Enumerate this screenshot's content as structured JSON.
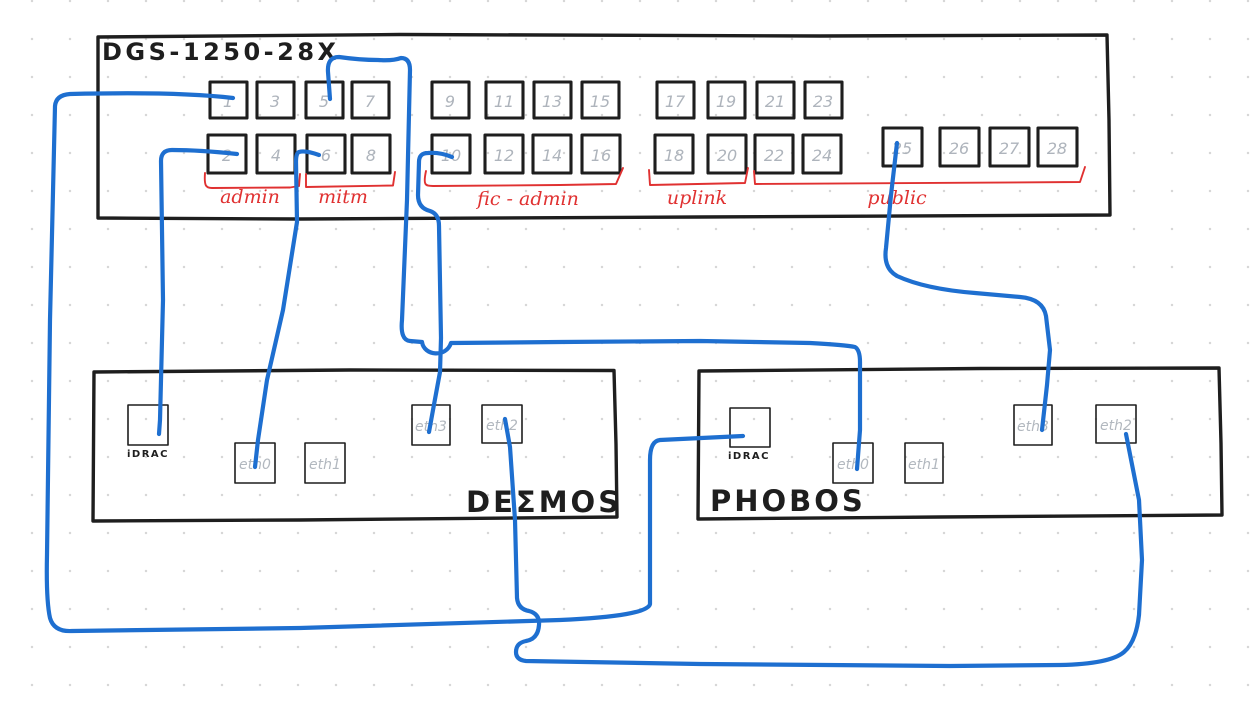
{
  "palette": {
    "background": "#ffffff",
    "ink": "#1e1e1e",
    "cable_blue": "#1e6fd0",
    "group_red": "#e03131",
    "muted_gray": "#aeb4bc"
  },
  "switch": {
    "title": "DGS-1250-28X",
    "ports": [
      "1",
      "2",
      "3",
      "4",
      "5",
      "6",
      "7",
      "8",
      "9",
      "10",
      "11",
      "12",
      "13",
      "14",
      "15",
      "16",
      "17",
      "18",
      "19",
      "20",
      "21",
      "22",
      "23",
      "24",
      "25",
      "26",
      "27",
      "28"
    ],
    "groups": [
      {
        "label": "admin",
        "ports": [
          1,
          2,
          3,
          4
        ]
      },
      {
        "label": "mitm",
        "ports": [
          5,
          6,
          7,
          8
        ]
      },
      {
        "label": "fic - admin",
        "ports": [
          9,
          10,
          11,
          12,
          13,
          14,
          15,
          16
        ]
      },
      {
        "label": "uplink",
        "ports": [
          17,
          18,
          19,
          20
        ]
      },
      {
        "label": "public",
        "ports": [
          21,
          22,
          23,
          24,
          25,
          26,
          27,
          28
        ]
      }
    ]
  },
  "servers": [
    {
      "name": "DEΣMOS",
      "ports": [
        "iDRAC",
        "eth0",
        "eth1",
        "eth3",
        "eth2"
      ]
    },
    {
      "name": "PHOBOS",
      "ports": [
        "iDRAC",
        "eth0",
        "eth1",
        "eth3",
        "eth2"
      ]
    }
  ],
  "connections": [
    {
      "from": "switch port 1 (admin)",
      "to": "PHOBOS iDRAC"
    },
    {
      "from": "switch port 2 (admin)",
      "to": "DEΣMOS iDRAC"
    },
    {
      "from": "switch port 5 (mitm)",
      "to": "PHOBOS eth0"
    },
    {
      "from": "switch port 6 (mitm)",
      "to": "DEΣMOS eth0"
    },
    {
      "from": "switch port 10 (fic-admin)",
      "to": "DEΣMOS eth3"
    },
    {
      "from": "switch port 25 (public)",
      "to": "PHOBOS eth3"
    },
    {
      "from": "DEΣMOS eth2",
      "to": "PHOBOS eth2"
    }
  ]
}
